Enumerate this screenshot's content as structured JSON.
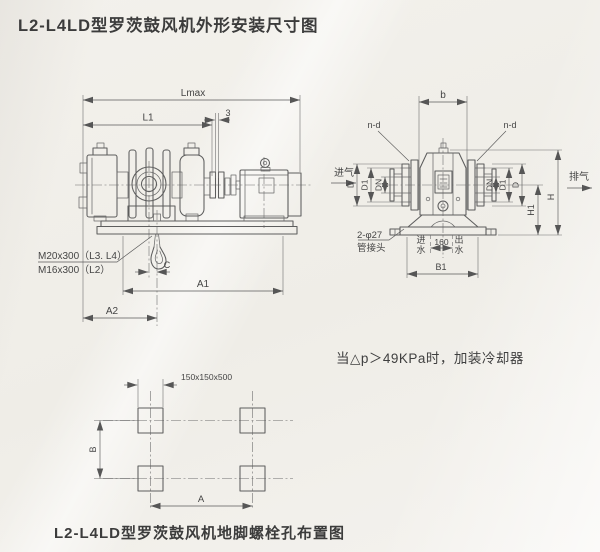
{
  "page": {
    "title": "L2-L4LD型罗茨鼓风机外形安装尺寸图",
    "cooler_note": "当△p＞49KPa时，加装冷却器",
    "bottom_caption": "L2-L4LD型罗茨鼓风机地脚螺栓孔布置图"
  },
  "side_view": {
    "dim_lmax": "Lmax",
    "dim_l1": "L1",
    "dim_gap": "3",
    "dim_c": "C",
    "dim_a1": "A1",
    "dim_a2": "A2",
    "anchor_bolt_spec_l3_l4": "M20x300（L3. L4）",
    "anchor_bolt_spec_l2": "M16x300（L2）"
  },
  "front_view": {
    "dim_b": "b",
    "dim_nd_left": "n-d",
    "dim_nd_right": "n-d",
    "dim_d_left": "D",
    "dim_d1_left": "D1",
    "dim_dn_left": "DN",
    "dim_dn_right": "DN",
    "dim_d1_right": "D1",
    "dim_d_right": "D",
    "dim_h1": "H1",
    "dim_h": "H",
    "dim_b1": "B1",
    "dim_160": "160",
    "label_inlet": "进气",
    "label_outlet": "排气",
    "label_pipe_qty": "2-φ27",
    "label_pipe_joint": "管接头",
    "water_in_char1": "进",
    "water_in_char2": "水",
    "water_out_char1": "出",
    "water_out_char2": "水"
  },
  "bolt_layout": {
    "dim_pocket": "150x150x500",
    "dim_a": "A",
    "dim_b": "B"
  },
  "colors": {
    "paper": "#f1efe9",
    "line": "#5d5d5d",
    "text": "#454545"
  }
}
